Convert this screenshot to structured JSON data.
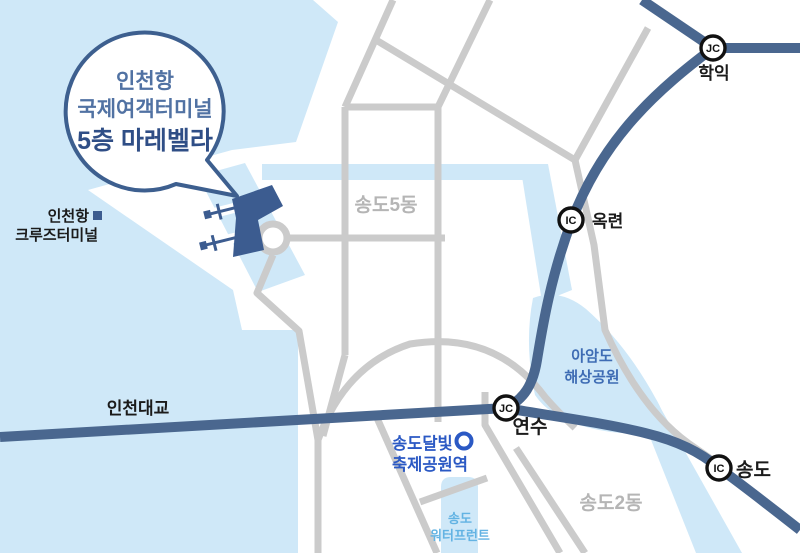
{
  "bubble": {
    "line1": "인천항",
    "line2": "국제여객터미널",
    "line3": "5층 마레벨라"
  },
  "cruise_terminal": {
    "line1": "인천항",
    "line2": "크루즈터미널"
  },
  "districts": {
    "songdo5": "송도5동",
    "songdo2": "송도2동"
  },
  "interchanges": {
    "hagik": {
      "type": "JC",
      "name": "학익"
    },
    "okryeon": {
      "type": "IC",
      "name": "옥련"
    },
    "yeonsu": {
      "type": "JC",
      "name": "연수"
    },
    "songdo": {
      "type": "IC",
      "name": "송도"
    }
  },
  "roads": {
    "incheon_bridge": "인천대교"
  },
  "park": {
    "line1": "아암도",
    "line2": "해상공원"
  },
  "station": {
    "line1": "송도달빛",
    "line2": "축제공원역"
  },
  "waterfront": {
    "line1": "송도",
    "line2": "워터프런트"
  },
  "colors": {
    "water": "#CFE8F8",
    "road_gray": "#CBCBCB",
    "road_blue": "#4A678F",
    "terminal_navy": "#3C5C90",
    "bubble_border": "#3D5F8F",
    "bubble_text": "#5172A3",
    "bubble_text_strong": "#2F4E86",
    "station_blue": "#2B59C4",
    "park_blue": "#3E6CB4",
    "waterfront_blue": "#63B3E3",
    "district_gray": "#B5B5B5",
    "label_dark": "#1B1B1B",
    "badge_black": "#111111"
  }
}
